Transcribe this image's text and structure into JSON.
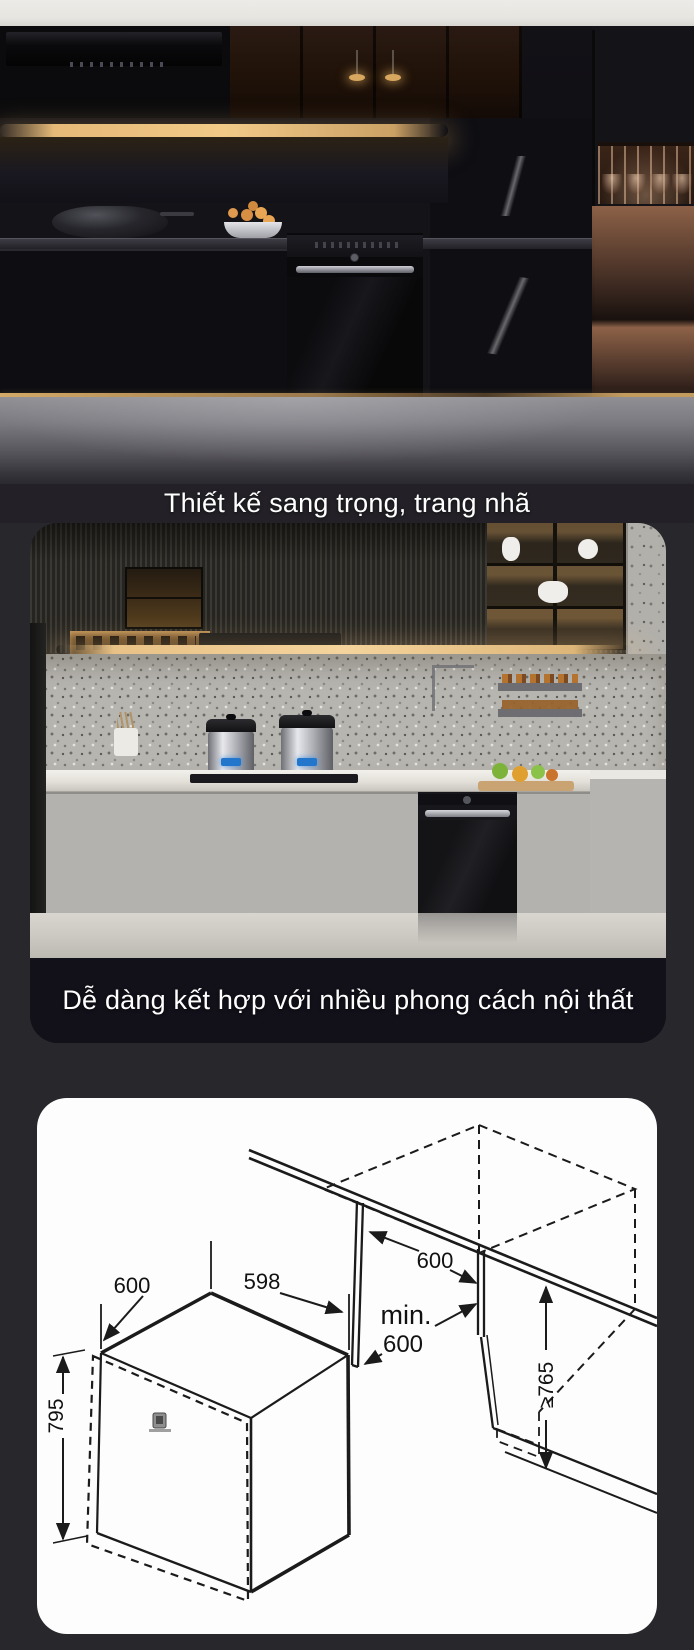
{
  "captions": {
    "design": "Thiết kế sang trọng, trang nhã",
    "compatibility": "Dễ dàng kết hợp với nhiều phong cách nội thất"
  },
  "diagram": {
    "box_depth": "600",
    "box_width": "598",
    "box_height": "795",
    "counter_depth": "600",
    "niche_min_label": "min.",
    "niche_min_value": "600",
    "niche_height": "≥765"
  },
  "colors": {
    "page_bg": "#28272c",
    "caption_band_dark": "#121019",
    "caption_text": "#ffffff",
    "card_bg": "#fdfdfd",
    "diagram_line": "#1b1b1b",
    "copper_accent": "#8a5f45",
    "warm_light": "#e8c186"
  }
}
